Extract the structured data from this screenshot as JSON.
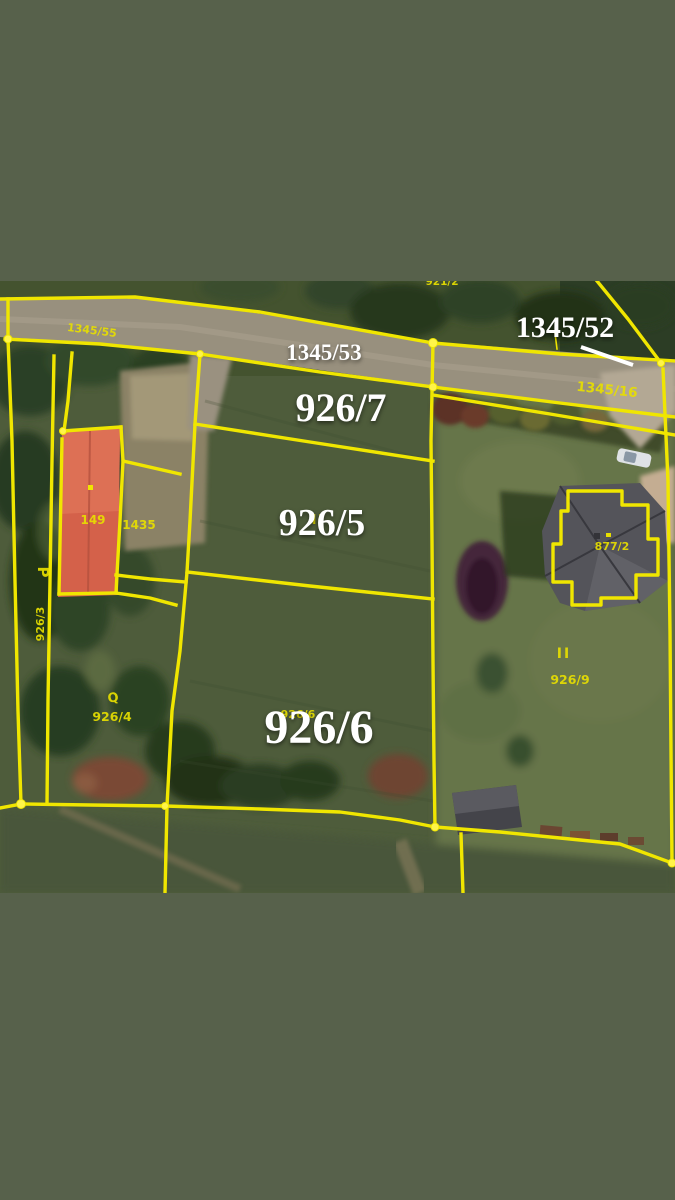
{
  "map": {
    "type": "cadastral-parcel-overlay-on-aerial-photo",
    "labels": {
      "plot_1345_52": "1345/52",
      "plot_1345_53": "1345/53",
      "plot_926_7": "926/7",
      "plot_926_5": "926/5",
      "plot_926_6": "926/6",
      "road_1345_55": "1345/55",
      "road_1345_16": "1345/16",
      "top_partial": "921/2",
      "building_149": "149",
      "yard_1435": "1435",
      "plot_926_4": "926/4",
      "plot_926_9": "926/9",
      "house_877_2": "877/2",
      "plot_926_3": "926/3",
      "small_926_6": "926/6",
      "symbol_p": "P",
      "symbol_q": "Q",
      "symbol_ii": "II",
      "symbol_ii_2": "II"
    },
    "colors": {
      "letterbox": "#57614b",
      "boundary_yellow": "#f0e600",
      "label_white": "#ffffff",
      "label_yellow": "#e8df00",
      "roof_red": "#d4614a",
      "roof_gray": "#54545a",
      "road_gray": "#98907e",
      "grass_dark": "#4e5c3b",
      "lawn_light": "#66744a"
    }
  }
}
